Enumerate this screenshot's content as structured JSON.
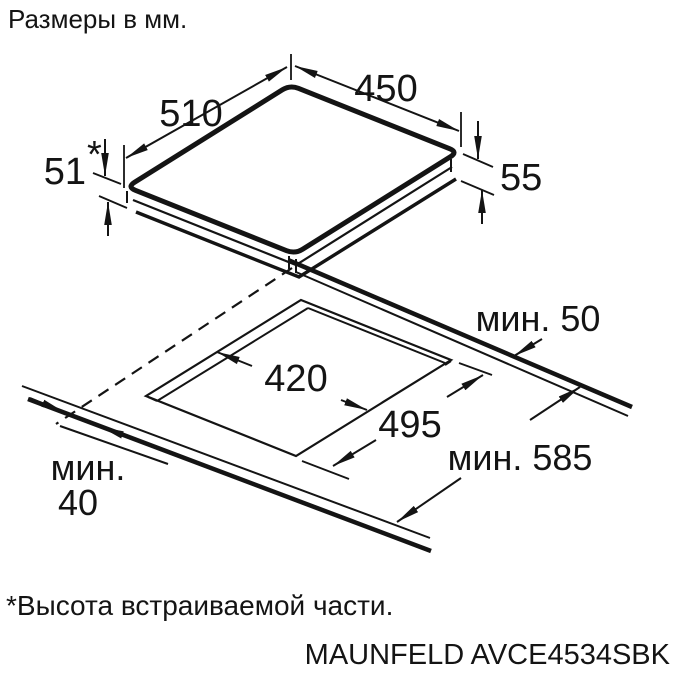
{
  "title": "Размеры в мм.",
  "footnote": "*Высота встраиваемой части.",
  "model": "MAUNFELD AVCE4534SBK",
  "colors": {
    "ink": "#141414",
    "background": "#ffffff"
  },
  "cooktop": {
    "width_top": "450",
    "depth_top": "510",
    "builtin_height": "51",
    "builtin_height_star": "*",
    "body_height": "55"
  },
  "cutout": {
    "width": "420",
    "depth": "495",
    "min_back_clearance": "мин. 50",
    "min_worktop_depth": "мин. 585",
    "min_front_line1": "мин.",
    "min_front_line2": "40"
  }
}
